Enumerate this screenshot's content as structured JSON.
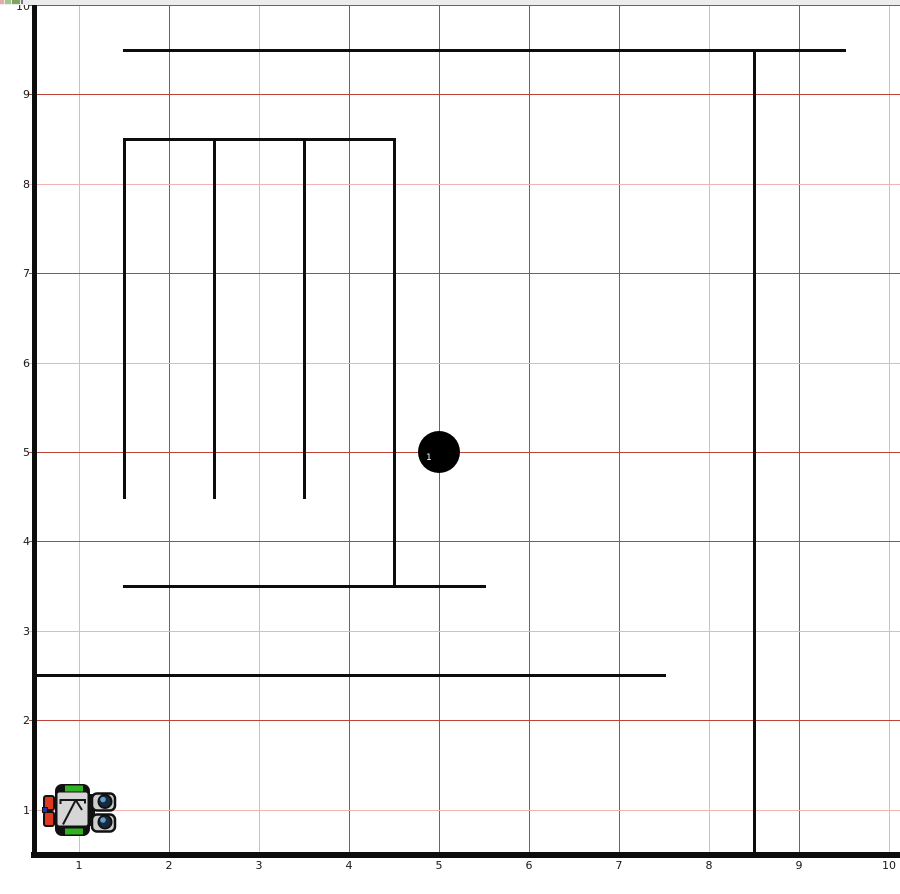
{
  "colors": {
    "background": "#ffffff",
    "top_strip": "#ececec",
    "grid_dark": "#bf4138",
    "grid_light": "#f1b3b1",
    "wall": "#0d0d0d",
    "axis_label": "#1a1a1a",
    "puck": "#000000",
    "puck_label": "#ffffff"
  },
  "axes": {
    "x_labels": [
      "1",
      "2",
      "3",
      "4",
      "5",
      "6",
      "7",
      "8",
      "9",
      "10"
    ],
    "y_labels": [
      "1",
      "2",
      "3",
      "4",
      "5",
      "6",
      "7",
      "8",
      "9",
      "10"
    ]
  },
  "grid": {
    "vertical": [
      {
        "x": 1,
        "shade": "light"
      },
      {
        "x": 2,
        "shade": "dark"
      },
      {
        "x": 3,
        "shade": "light"
      },
      {
        "x": 4,
        "shade": "dark"
      },
      {
        "x": 5,
        "shade": "dark"
      },
      {
        "x": 6,
        "shade": "dark"
      },
      {
        "x": 7,
        "shade": "dark"
      },
      {
        "x": 8,
        "shade": "light"
      },
      {
        "x": 9,
        "shade": "dark"
      },
      {
        "x": 10,
        "shade": "light"
      }
    ],
    "horizontal": [
      {
        "y": 1,
        "shade": "light"
      },
      {
        "y": 2,
        "shade": "dark"
      },
      {
        "y": 3,
        "shade": "light"
      },
      {
        "y": 4,
        "shade": "dark"
      },
      {
        "y": 5,
        "shade": "dark"
      },
      {
        "y": 6,
        "shade": "light"
      },
      {
        "y": 7,
        "shade": "dark"
      },
      {
        "y": 8,
        "shade": "light"
      },
      {
        "y": 9,
        "shade": "dark"
      },
      {
        "y": 10,
        "shade": "dark"
      }
    ]
  },
  "walls": [
    {
      "name": "left-boundary-wall",
      "x1": 0.5,
      "y1": 0.5,
      "x2": 0.5,
      "y2": 9.98,
      "thickness": 5
    },
    {
      "name": "bottom-boundary-wall",
      "x1": 0.5,
      "y1": 0.5,
      "x2": 10.15,
      "y2": 0.5,
      "thickness": 6
    },
    {
      "name": "top-wall",
      "x1": 1.5,
      "y1": 9.5,
      "x2": 9.5,
      "y2": 9.5,
      "thickness": 3
    },
    {
      "name": "right-wall",
      "x1": 8.5,
      "y1": 0.5,
      "x2": 8.5,
      "y2": 9.5,
      "thickness": 3
    },
    {
      "name": "room-top-wall",
      "x1": 1.5,
      "y1": 8.5,
      "x2": 4.5,
      "y2": 8.5,
      "thickness": 3
    },
    {
      "name": "room-left-wall",
      "x1": 1.5,
      "y1": 4.5,
      "x2": 1.5,
      "y2": 8.5,
      "thickness": 3
    },
    {
      "name": "room-divider-1",
      "x1": 2.5,
      "y1": 4.5,
      "x2": 2.5,
      "y2": 8.5,
      "thickness": 3
    },
    {
      "name": "room-divider-2",
      "x1": 3.5,
      "y1": 4.5,
      "x2": 3.5,
      "y2": 8.5,
      "thickness": 3
    },
    {
      "name": "room-right-wall",
      "x1": 4.5,
      "y1": 3.5,
      "x2": 4.5,
      "y2": 8.5,
      "thickness": 3
    },
    {
      "name": "room-bottom-wall",
      "x1": 1.5,
      "y1": 3.5,
      "x2": 5.5,
      "y2": 3.5,
      "thickness": 3
    },
    {
      "name": "low-long-wall",
      "x1": 0.5,
      "y1": 2.5,
      "x2": 7.5,
      "y2": 2.5,
      "thickness": 3
    }
  ],
  "puck": {
    "label": "1",
    "x": 5,
    "y": 5,
    "radius_px": 21
  },
  "robot": {
    "x": 1.0,
    "y": 1.0,
    "heading_deg": 0,
    "colors": {
      "body": "#d6d6d6",
      "frame": "#111111",
      "tread": "#2fb322",
      "red": "#e0391f",
      "blue": "#2233aa",
      "paddle": "#cdcdcd",
      "eye": "#16293f",
      "eye_hl": "#5f9fd0"
    }
  },
  "top_strip_fragments": [
    {
      "x": 0,
      "w": 4,
      "color": "#e3aca4"
    },
    {
      "x": 5,
      "w": 6,
      "color": "#a6c490"
    },
    {
      "x": 12,
      "w": 8,
      "color": "#7da55e"
    },
    {
      "x": 21,
      "w": 2,
      "color": "#777777"
    }
  ]
}
